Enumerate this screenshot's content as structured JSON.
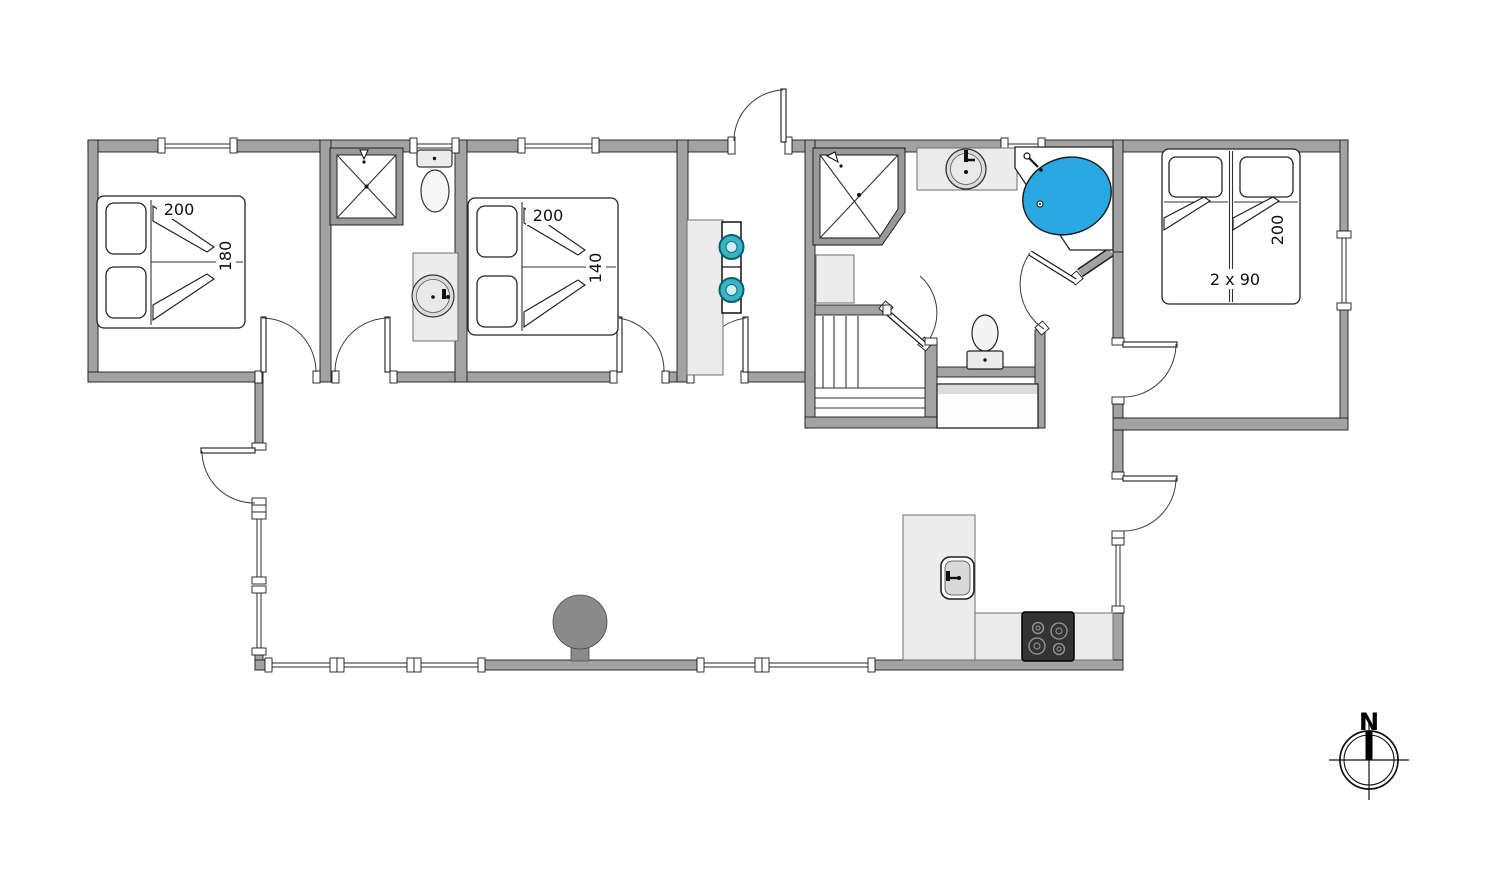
{
  "plan": {
    "type": "holiday-home-floor-plan",
    "labels": {
      "bed_left_width": "200",
      "bed_left_depth": "180",
      "bed_mid_width": "200",
      "bed_mid_depth": "140",
      "bed_right_count": "2 x 90",
      "bed_right_length": "200",
      "compass_north": "N"
    },
    "colors": {
      "wall": "#a3a3a3",
      "bathtub": "#29a9e2",
      "appliance_accent": "#39b3c5",
      "cooktop": "#333333",
      "wood_stove": "#8a8a8a"
    },
    "fixtures": [
      "double-bed-200x180",
      "double-bed-200x140",
      "twin-beds-2x90x200",
      "shower-cabin-left",
      "toilet-left",
      "vanity-sink-left",
      "washer-dryer-stack",
      "stairs",
      "shower-cabin-right",
      "round-sink-counter",
      "corner-bathtub",
      "toilet-right",
      "kitchen-island-sink",
      "cooktop-4-burners",
      "wood-stove",
      "cabinet",
      "closet",
      "compass-rose"
    ]
  }
}
